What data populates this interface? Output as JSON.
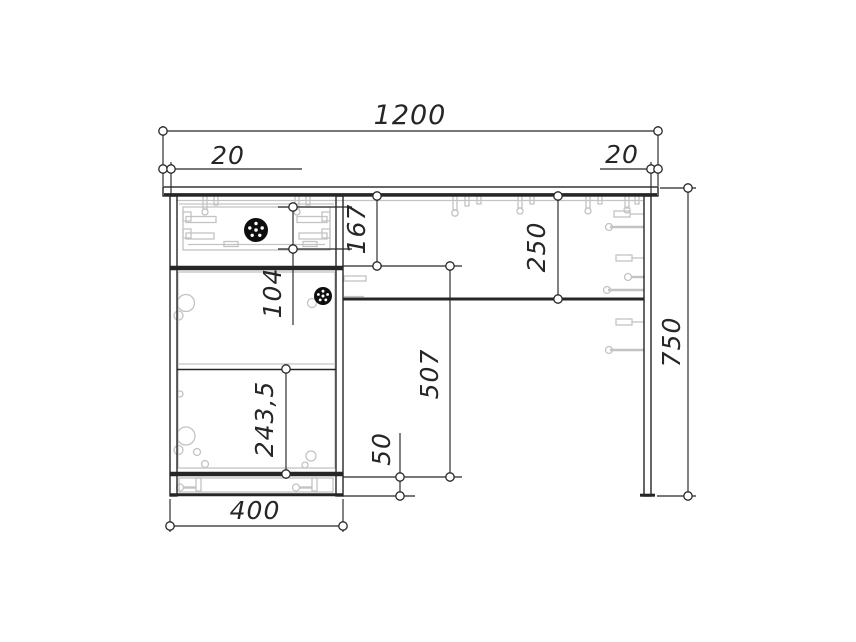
{
  "drawing": {
    "kind": "furniture assembly drawing (front view of desk with pedestal)",
    "dims": {
      "overall_width": "1200",
      "overhang_left": "20",
      "overhang_right": "20",
      "drawer_section_height": "167",
      "top_to_shelf": "250",
      "drawer_front_height": "104",
      "door_shelf_spacing": "243,5",
      "door_section_height": "507",
      "plinth_height": "50",
      "overall_height": "750",
      "pedestal_width": "400"
    }
  },
  "colors": {
    "line": "#262626",
    "hw": "#c3c3c3",
    "knob": "#0e0e0e",
    "bg": "#ffffff"
  }
}
